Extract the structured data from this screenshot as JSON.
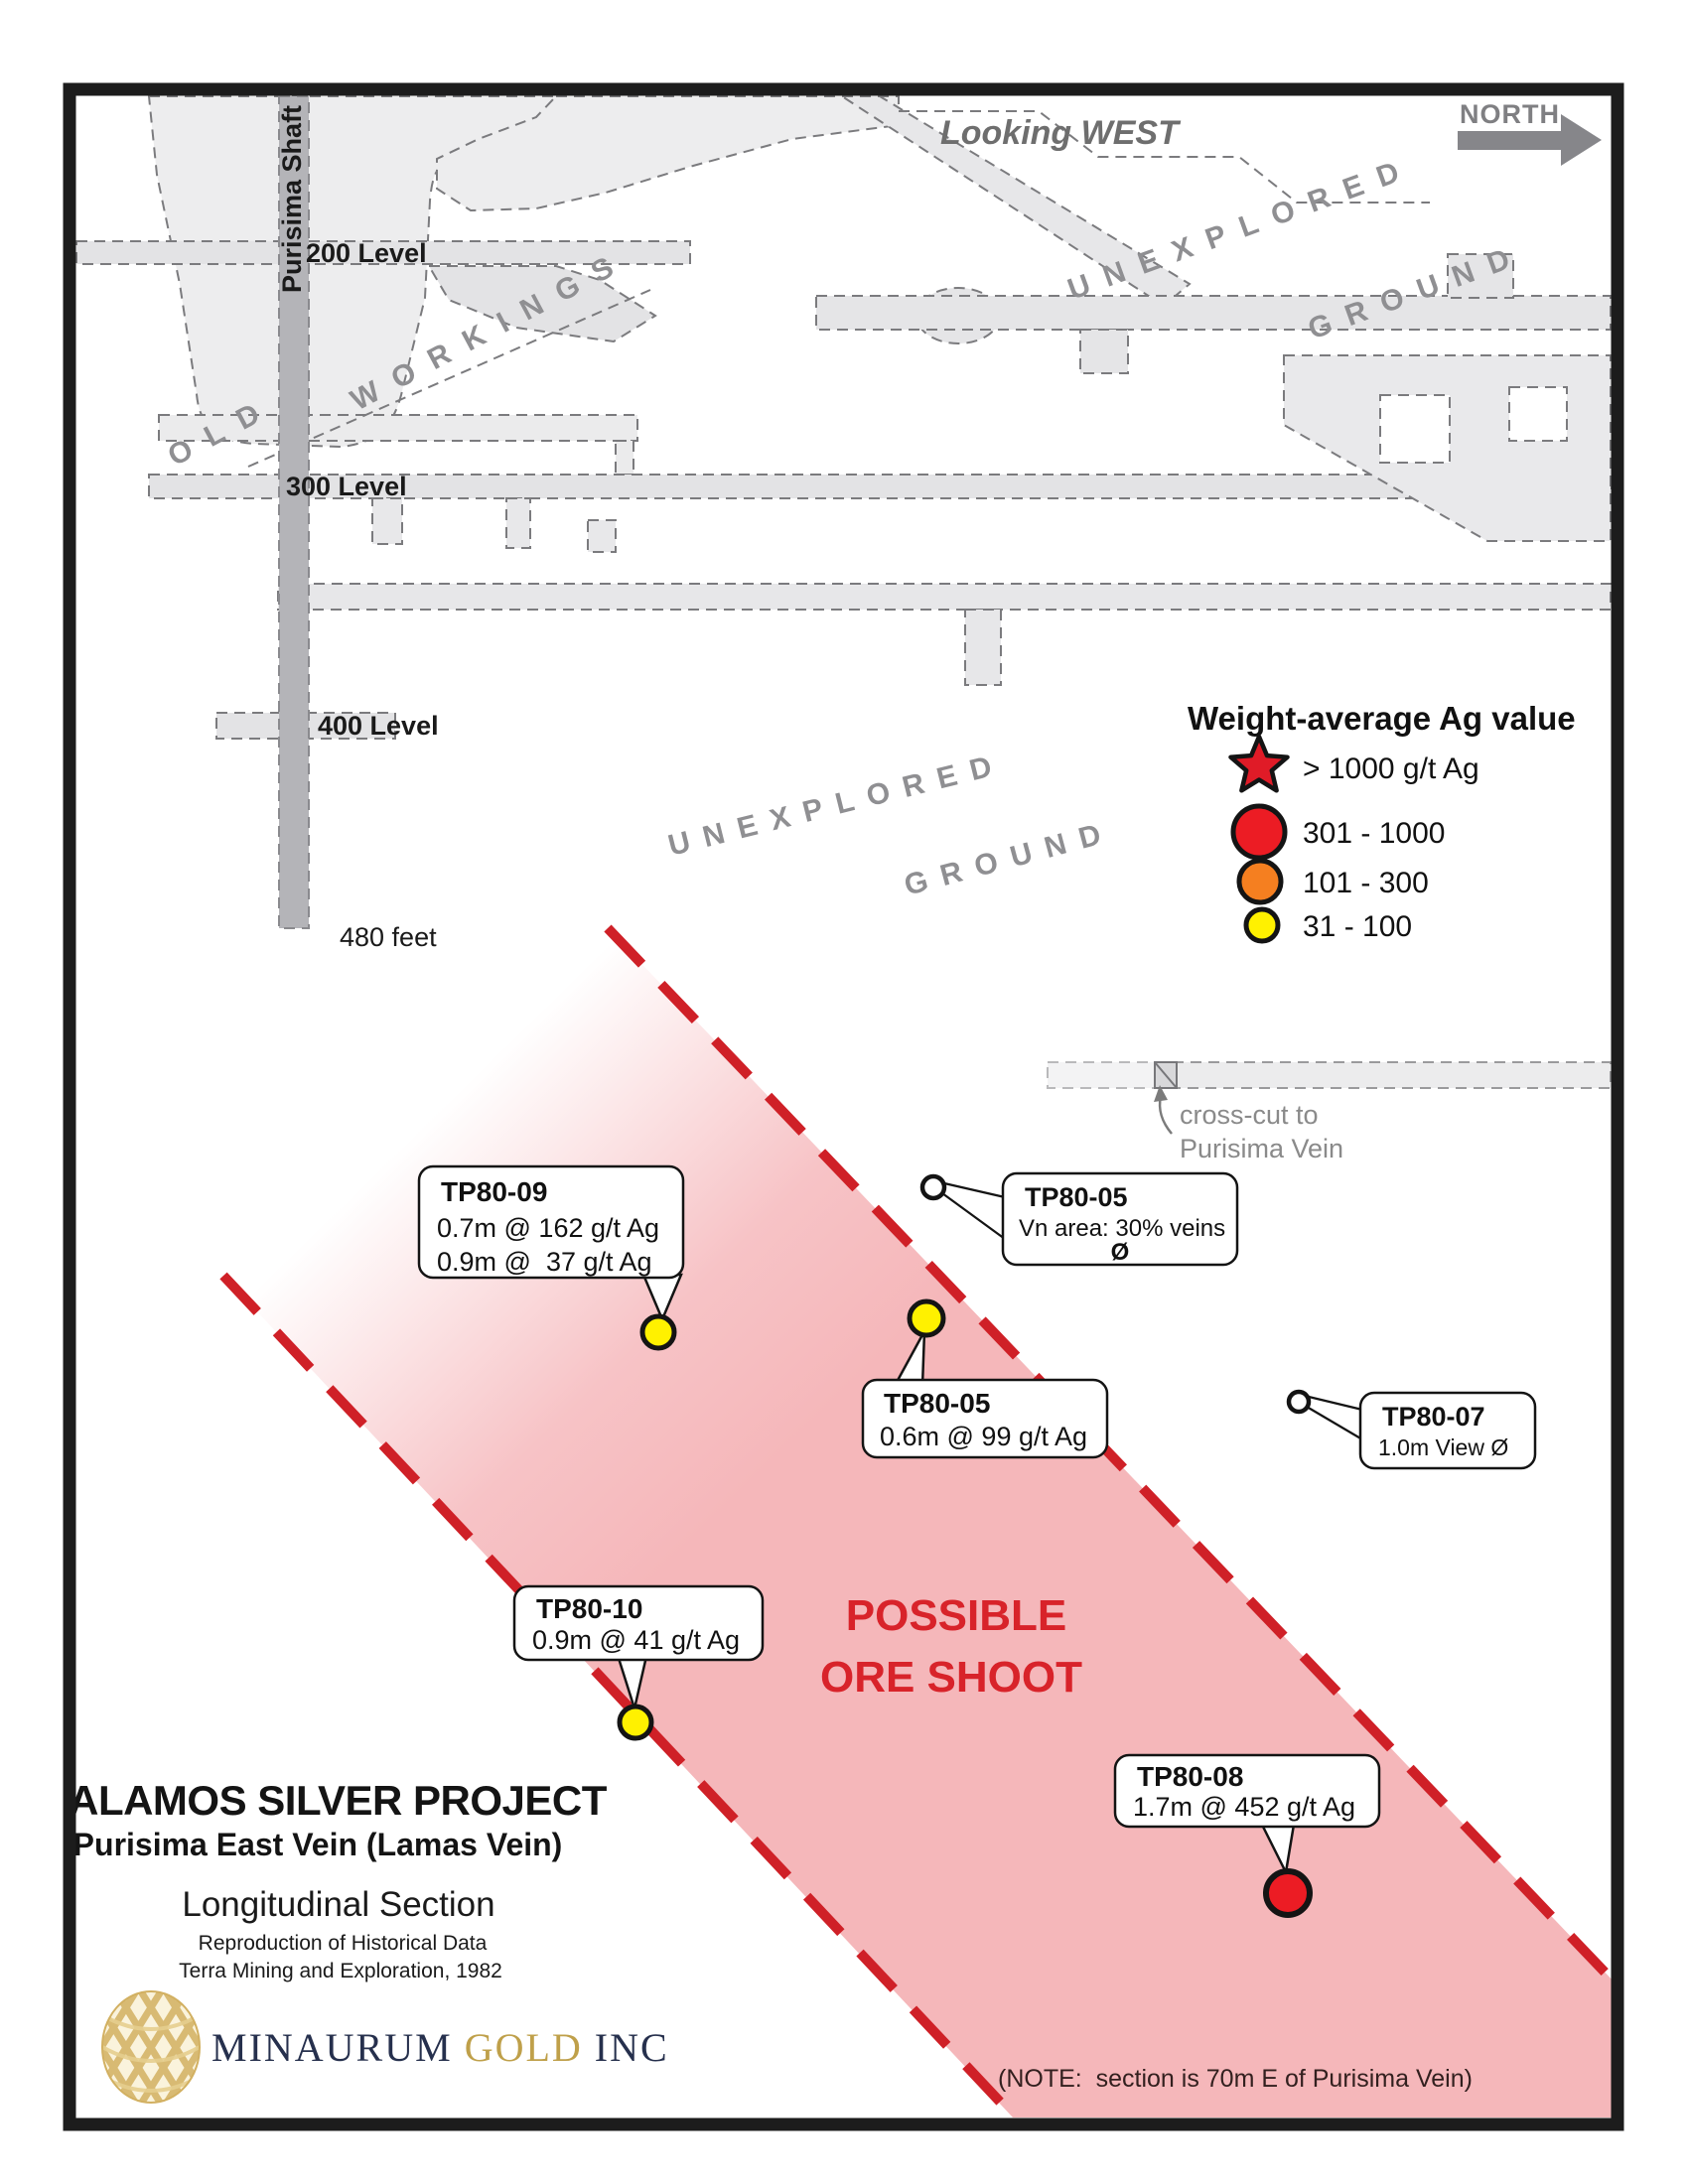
{
  "frame": {
    "looking_west": "Looking WEST",
    "north_label": "NORTH"
  },
  "mine": {
    "shaft_label": "Purisima Shaft",
    "level_200": "200 Level",
    "level_300": "300 Level",
    "level_400": "400 Level",
    "depth_label": "480 feet",
    "old_workings_word1": "OLD",
    "old_workings_word2": "WORKINGS",
    "unexplored_word1": "UNEXPLORED",
    "unexplored_word2": "GROUND",
    "crosscut_line1": "cross-cut to",
    "crosscut_line2": "Purisima Vein"
  },
  "legend": {
    "title": "Weight-average Ag value",
    "items": [
      {
        "symbol": "star",
        "color": "#e01b27",
        "label": "> 1000 g/t Ag"
      },
      {
        "symbol": "large-circle",
        "color": "#ec1c24",
        "label": "301 - 1000"
      },
      {
        "symbol": "medium-circle",
        "color": "#f57f20",
        "label": "101 - 300"
      },
      {
        "symbol": "small-circle",
        "color": "#fff100",
        "label": "31 - 100"
      }
    ]
  },
  "ore_shoot": {
    "label_line1": "POSSIBLE",
    "label_line2": "ORE SHOOT",
    "color": "#d8232a",
    "band_pink": "#f5b7ba",
    "dash_red": "#cf2027"
  },
  "callouts": [
    {
      "hole": "TP80-09",
      "line1": "0.7m @ 162 g/t Ag",
      "line2": "0.9m @  37 g/t Ag",
      "marker": "yellow-dot"
    },
    {
      "hole": "TP80-05",
      "line1": "Vn area: 30% veins",
      "line2": "Ø",
      "marker": "open-circle"
    },
    {
      "hole": "TP80-05",
      "line1": "0.6m @ 99 g/t Ag",
      "marker": "yellow-dot"
    },
    {
      "hole": "TP80-07",
      "line1": "1.0m View Ø",
      "marker": "open-circle"
    },
    {
      "hole": "TP80-10",
      "line1": "0.9m @ 41 g/t Ag",
      "marker": "yellow-dot"
    },
    {
      "hole": "TP80-08",
      "line1": "1.7m @ 452 g/t Ag",
      "marker": "red-dot"
    }
  ],
  "title_block": {
    "project": "ALAMOS SILVER PROJECT",
    "vein": "Purisima East Vein (Lamas Vein)",
    "section": "Longitudinal Section",
    "source_line1": "Reproduction of Historical Data",
    "source_line2": "Terra Mining and Exploration, 1982"
  },
  "logo": {
    "part1": "MINAURUM ",
    "part2": "GOLD",
    "part3": " INC",
    "navy": "#26304d",
    "gold": "#bfa04a"
  },
  "note": "(NOTE:  section is 70m E of Purisima Vein)"
}
